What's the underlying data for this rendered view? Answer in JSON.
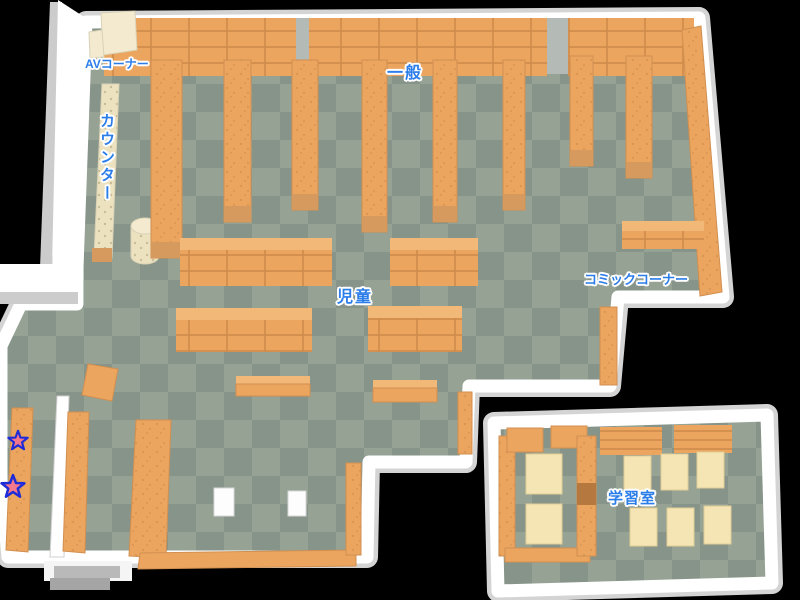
{
  "map": {
    "labels": {
      "av_corner": "AVコーナー",
      "counter": "カウンター",
      "general": "一般",
      "children": "児童",
      "comic_corner": "コミックコーナー",
      "study_room": "学習室"
    },
    "markers": [
      {
        "id": "star-1",
        "shape": "star",
        "x": 18,
        "y": 441,
        "scale": 0.85
      },
      {
        "id": "star-2",
        "shape": "star",
        "x": 13,
        "y": 487,
        "scale": 1.0
      }
    ],
    "colors": {
      "label_blue": "#2b7de9",
      "shelf_orange": "#eba55f",
      "shelf_dark": "#cd8a48",
      "shelf_top": "#f2b878",
      "floor_dark": "#87948a",
      "floor_light": "#95a294",
      "wall_white": "#ffffff",
      "wall_gray": "#cccccc",
      "cream": "#f3ead0",
      "table_cream": "#f5e4b4",
      "star_pink": "#f4788c",
      "star_blue": "#1d2bd8",
      "door_brown": "#b5793f",
      "background": "#000000"
    }
  }
}
